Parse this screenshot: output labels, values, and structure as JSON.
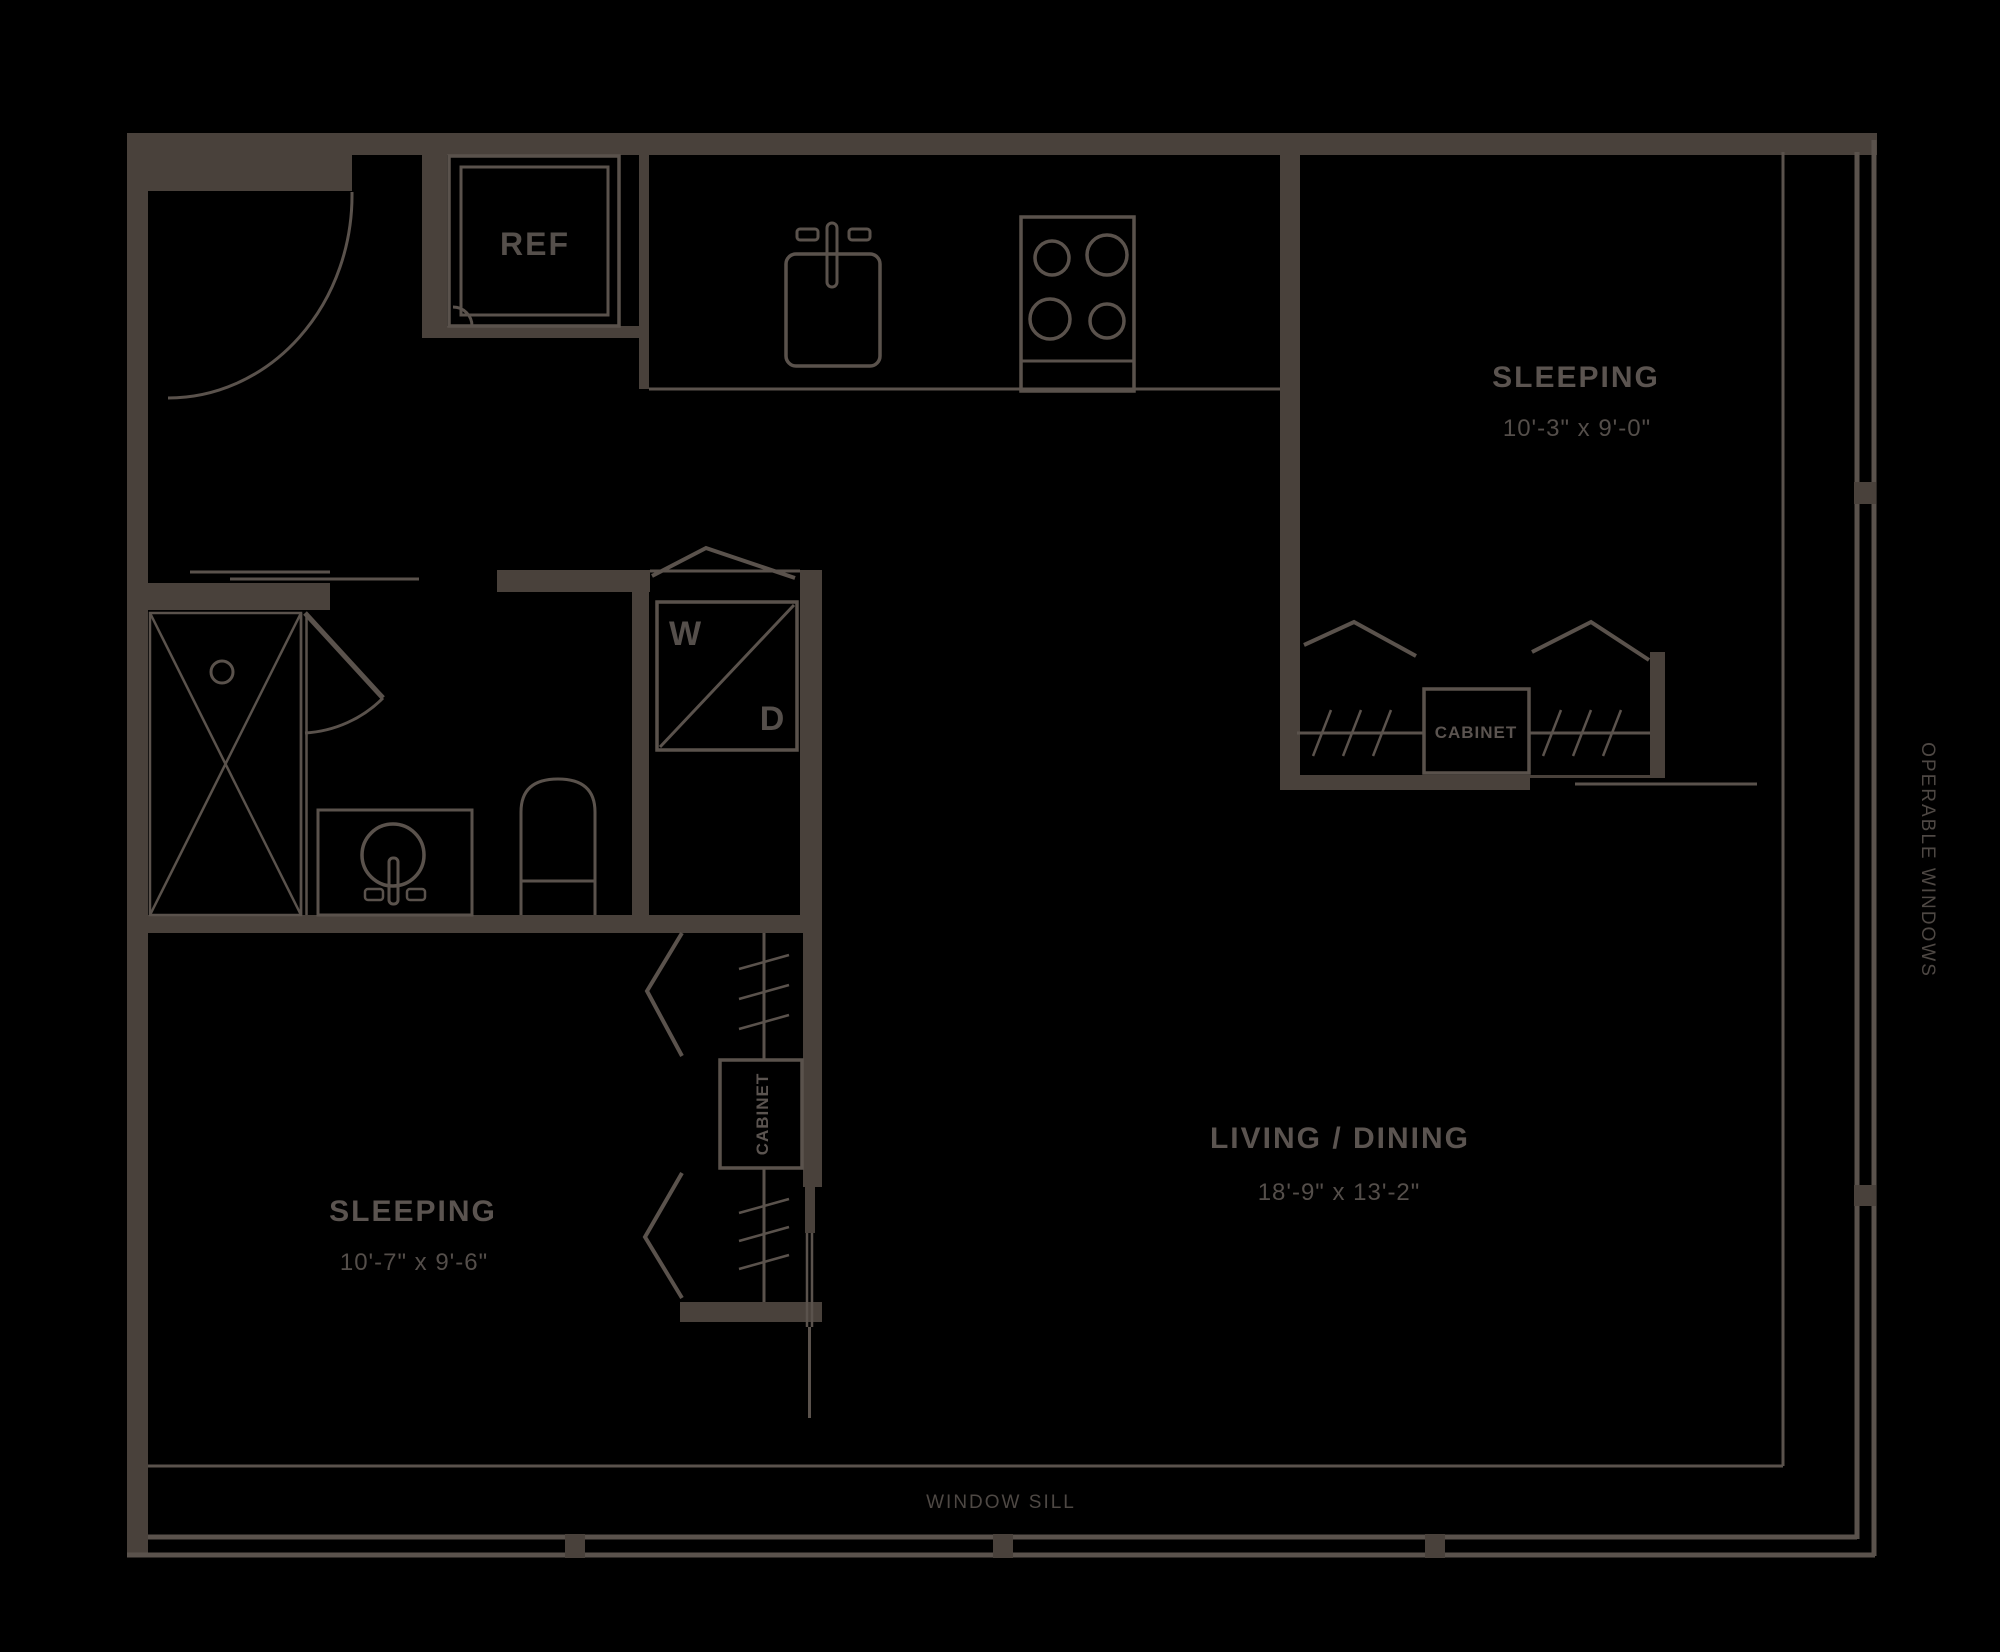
{
  "colors": {
    "background": "#000000",
    "wall": "#49413b",
    "line": "#5a524c",
    "label_text": "#5b5450",
    "dimension_text": "#544e4a",
    "annotation_text": "#4e4844"
  },
  "rooms": {
    "sleeping_1": {
      "label": "SLEEPING",
      "dimensions": "10'-3\" x 9'-0\""
    },
    "sleeping_2": {
      "label": "SLEEPING",
      "dimensions": "10'-7\" x 9'-6\""
    },
    "living_dining": {
      "label": "LIVING / DINING",
      "dimensions": "18'-9\" x 13'-2\""
    }
  },
  "fixtures": {
    "refrigerator": "REF",
    "washer": "W",
    "dryer": "D",
    "cabinet_bedroom_1": "CABINET",
    "cabinet_bedroom_2": "CABINET"
  },
  "annotations": {
    "window_sill": "WINDOW SILL",
    "operable_windows": "OPERABLE WINDOWS"
  }
}
